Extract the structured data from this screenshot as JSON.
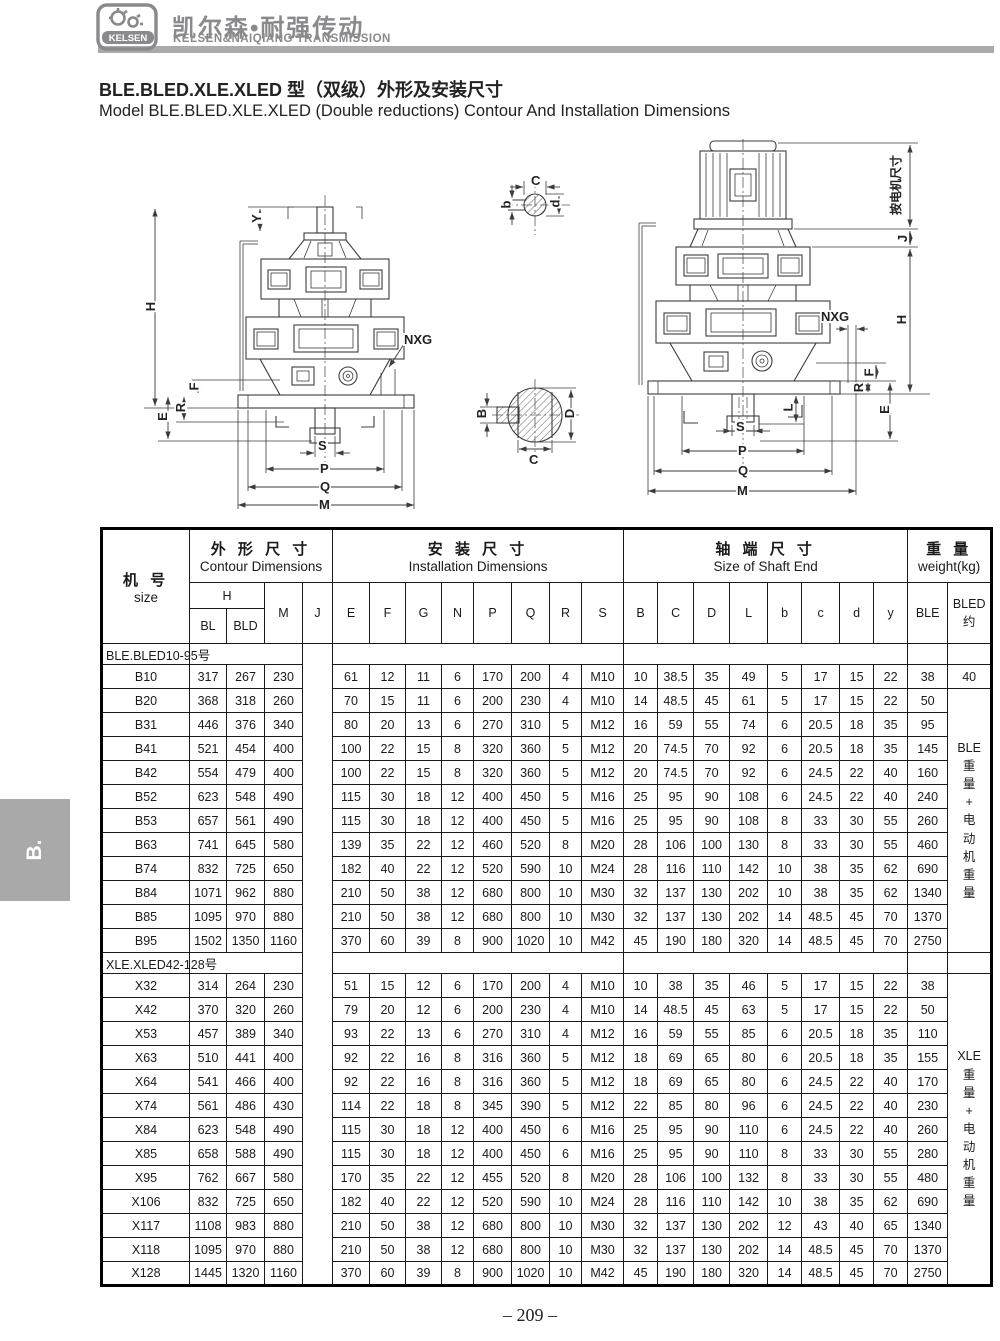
{
  "header": {
    "logo_text": "KELSEN",
    "brand_cn": "凯尔森•耐强传动",
    "brand_en": "KELSEN&NAIQIANG TRANSMISSION"
  },
  "side_tab": "B.",
  "title": {
    "line_cn": "BLE.BLED.XLE.XLED 型（双级）外形及安装尺寸",
    "line_en": "Model BLE.BLED.XLE.XLED (Double reductions) Contour And Installation Dimensions"
  },
  "drawings": {
    "left": {
      "y": "Y",
      "h": "H",
      "f": "F",
      "r": "R",
      "e": "E",
      "nxg": "NXG",
      "s": "S",
      "p": "P",
      "q": "Q",
      "m": "M"
    },
    "shaft_top": {
      "c": "C",
      "b": "b",
      "d": "d"
    },
    "shaft_bottom": {
      "b": "B",
      "c": "C",
      "d": "D"
    },
    "right": {
      "motor_dim": "按电机尺寸",
      "j": "J",
      "h": "H",
      "nxg": "NXG",
      "f": "F",
      "r": "R",
      "e": "E",
      "l": "L",
      "s": "S",
      "p": "P",
      "q": "Q",
      "m": "M"
    }
  },
  "table": {
    "col_size_cn": "机  号",
    "col_size_en": "size",
    "g1_cn": "外 形 尺 寸",
    "g1_en": "Contour Dimensions",
    "g2_cn": "安 装 尺 寸",
    "g2_en": "Installation Dimensions",
    "g3_cn": "轴 端 尺 寸",
    "g3_en": "Size of Shaft End",
    "g4_cn": "重 量",
    "g4_en": "weight(kg)",
    "h": "H",
    "bl": "BL",
    "bld": "BLD",
    "m": "M",
    "j": "J",
    "inst_cols": [
      "E",
      "F",
      "G",
      "N",
      "P",
      "Q",
      "R",
      "S"
    ],
    "shaft_cols": [
      "B",
      "C",
      "D",
      "L",
      "b",
      "c",
      "d",
      "y"
    ],
    "ble": "BLE",
    "bled_l1": "BLED",
    "bled_l2": "约",
    "sections": [
      {
        "label": "BLE.BLED10-95号",
        "note": [
          "BLE",
          "重",
          "量",
          "+",
          "电",
          "动",
          "机",
          "重",
          "量"
        ],
        "note_start": 1,
        "rows": [
          [
            "B10",
            317,
            267,
            230,
            61,
            12,
            11,
            6,
            170,
            200,
            4,
            "M10",
            10,
            38.5,
            35,
            49,
            5,
            17,
            15,
            22,
            38,
            40
          ],
          [
            "B20",
            368,
            318,
            260,
            70,
            15,
            11,
            6,
            200,
            230,
            4,
            "M10",
            14,
            48.5,
            45,
            61,
            5,
            17,
            15,
            22,
            50
          ],
          [
            "B31",
            446,
            376,
            340,
            80,
            20,
            13,
            6,
            270,
            310,
            5,
            "M12",
            16,
            59,
            55,
            74,
            6,
            20.5,
            18,
            35,
            95
          ],
          [
            "B41",
            521,
            454,
            400,
            100,
            22,
            15,
            8,
            320,
            360,
            5,
            "M12",
            20,
            74.5,
            70,
            92,
            6,
            20.5,
            18,
            35,
            145
          ],
          [
            "B42",
            554,
            479,
            400,
            100,
            22,
            15,
            8,
            320,
            360,
            5,
            "M12",
            20,
            74.5,
            70,
            92,
            6,
            24.5,
            22,
            40,
            160
          ],
          [
            "B52",
            623,
            548,
            490,
            115,
            30,
            18,
            12,
            400,
            450,
            5,
            "M16",
            25,
            95,
            90,
            108,
            6,
            24.5,
            22,
            40,
            240
          ],
          [
            "B53",
            657,
            561,
            490,
            115,
            30,
            18,
            12,
            400,
            450,
            5,
            "M16",
            25,
            95,
            90,
            108,
            8,
            33,
            30,
            55,
            260
          ],
          [
            "B63",
            741,
            645,
            580,
            139,
            35,
            22,
            12,
            460,
            520,
            8,
            "M20",
            28,
            106,
            100,
            130,
            8,
            33,
            30,
            55,
            460
          ],
          [
            "B74",
            832,
            725,
            650,
            182,
            40,
            22,
            12,
            520,
            590,
            10,
            "M24",
            28,
            116,
            110,
            142,
            10,
            38,
            35,
            62,
            690
          ],
          [
            "B84",
            1071,
            962,
            880,
            210,
            50,
            38,
            12,
            680,
            800,
            10,
            "M30",
            32,
            137,
            130,
            202,
            10,
            38,
            35,
            62,
            1340
          ],
          [
            "B85",
            1095,
            970,
            880,
            210,
            50,
            38,
            12,
            680,
            800,
            10,
            "M30",
            32,
            137,
            130,
            202,
            14,
            48.5,
            45,
            70,
            1370
          ],
          [
            "B95",
            1502,
            1350,
            1160,
            370,
            60,
            39,
            8,
            900,
            1020,
            10,
            "M42",
            45,
            190,
            180,
            320,
            14,
            48.5,
            45,
            70,
            2750
          ]
        ]
      },
      {
        "label": "XLE.XLED42-128号",
        "note": [
          "XLE",
          "重",
          "量",
          "+",
          "电",
          "动",
          "机",
          "重",
          "量"
        ],
        "note_start": 0,
        "rows": [
          [
            "X32",
            314,
            264,
            230,
            51,
            15,
            12,
            6,
            170,
            200,
            4,
            "M10",
            10,
            38,
            35,
            46,
            5,
            17,
            15,
            22,
            38
          ],
          [
            "X42",
            370,
            320,
            260,
            79,
            20,
            12,
            6,
            200,
            230,
            4,
            "M10",
            14,
            48.5,
            45,
            63,
            5,
            17,
            15,
            22,
            50
          ],
          [
            "X53",
            457,
            389,
            340,
            93,
            22,
            13,
            6,
            270,
            310,
            4,
            "M12",
            16,
            59,
            55,
            85,
            6,
            20.5,
            18,
            35,
            110
          ],
          [
            "X63",
            510,
            441,
            400,
            92,
            22,
            16,
            8,
            316,
            360,
            5,
            "M12",
            18,
            69,
            65,
            80,
            6,
            20.5,
            18,
            35,
            155
          ],
          [
            "X64",
            541,
            466,
            400,
            92,
            22,
            16,
            8,
            316,
            360,
            5,
            "M12",
            18,
            69,
            65,
            80,
            6,
            24.5,
            22,
            40,
            170
          ],
          [
            "X74",
            561,
            486,
            430,
            114,
            22,
            18,
            8,
            345,
            390,
            5,
            "M12",
            22,
            85,
            80,
            96,
            6,
            24.5,
            22,
            40,
            230
          ],
          [
            "X84",
            623,
            548,
            490,
            115,
            30,
            18,
            12,
            400,
            450,
            6,
            "M16",
            25,
            95,
            90,
            110,
            6,
            24.5,
            22,
            40,
            260
          ],
          [
            "X85",
            658,
            588,
            490,
            115,
            30,
            18,
            12,
            400,
            450,
            6,
            "M16",
            25,
            95,
            90,
            110,
            8,
            33,
            30,
            55,
            280
          ],
          [
            "X95",
            762,
            667,
            580,
            170,
            35,
            22,
            12,
            455,
            520,
            8,
            "M20",
            28,
            106,
            100,
            132,
            8,
            33,
            30,
            55,
            480
          ],
          [
            "X106",
            832,
            725,
            650,
            182,
            40,
            22,
            12,
            520,
            590,
            10,
            "M24",
            28,
            116,
            110,
            142,
            10,
            38,
            35,
            62,
            690
          ],
          [
            "X117",
            1108,
            983,
            880,
            210,
            50,
            38,
            12,
            680,
            800,
            10,
            "M30",
            32,
            137,
            130,
            202,
            12,
            43,
            40,
            65,
            1340
          ],
          [
            "X118",
            1095,
            970,
            880,
            210,
            50,
            38,
            12,
            680,
            800,
            10,
            "M30",
            32,
            137,
            130,
            202,
            14,
            48.5,
            45,
            70,
            1370
          ],
          [
            "X128",
            1445,
            1320,
            1160,
            370,
            60,
            39,
            8,
            900,
            1020,
            10,
            "M42",
            45,
            190,
            180,
            320,
            14,
            48.5,
            45,
            70,
            2750
          ]
        ]
      }
    ]
  },
  "page_number": "– 209 –"
}
